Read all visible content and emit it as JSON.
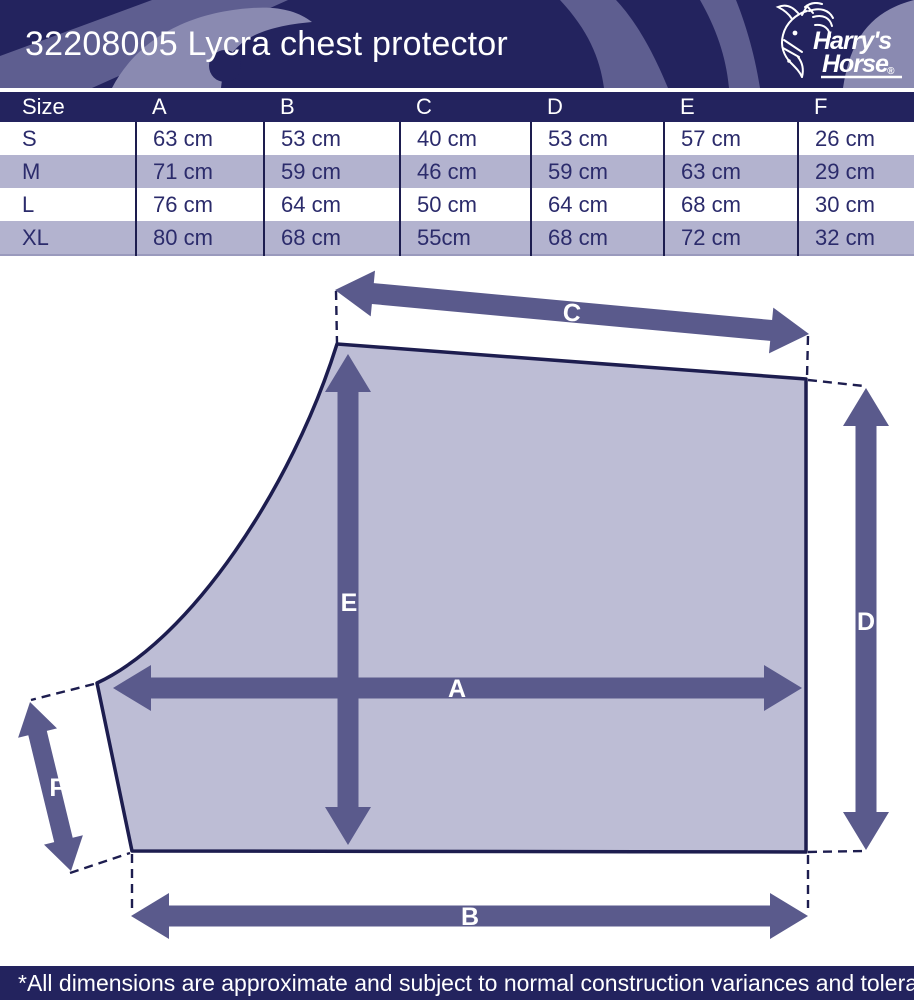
{
  "header": {
    "title": "32208005 Lycra chest protector",
    "logo": {
      "brand_line1": "Harry's",
      "brand_line2": "Horse",
      "registered": "®"
    }
  },
  "table": {
    "headers": [
      "Size",
      "A",
      "B",
      "C",
      "D",
      "E",
      "F"
    ],
    "rows": [
      [
        "S",
        "63 cm",
        "53 cm",
        "40 cm",
        "53 cm",
        "57 cm",
        "26 cm"
      ],
      [
        "M",
        "71 cm",
        "59 cm",
        "46 cm",
        "59 cm",
        "63 cm",
        "29 cm"
      ],
      [
        "L",
        "76 cm",
        "64 cm",
        "50 cm",
        "64 cm",
        "68 cm",
        "30 cm"
      ],
      [
        "XL",
        "80 cm",
        "68 cm",
        "55cm",
        "68 cm",
        "72 cm",
        "32 cm"
      ]
    ]
  },
  "diagram": {
    "labels": {
      "a": "A",
      "b": "B",
      "c": "C",
      "d": "D",
      "e": "E",
      "f": "F"
    }
  },
  "footer": {
    "note": "*All dimensions are approximate and subject to normal construction variances and tolerances"
  },
  "colors": {
    "navy_banner": "#23235e",
    "outline_navy": "#1d1d4f",
    "panel_fill": "#bdbdd5",
    "arrow_purple": "#5a5a8c",
    "row_alt_purple": "#b3b3cf",
    "cell_text_navy": "#2b2b6b",
    "deco_light": "#8a8ab1",
    "deco_mid": "#5e5e90"
  }
}
